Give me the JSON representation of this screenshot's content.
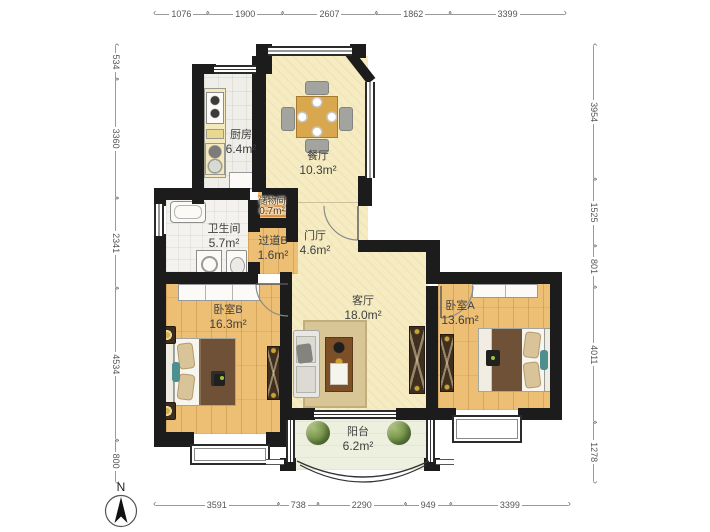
{
  "plan": {
    "compass_label": "N",
    "rooms": [
      {
        "id": "kitchen",
        "name": "厨房",
        "area": "6.4m²"
      },
      {
        "id": "dining",
        "name": "餐厅",
        "area": "10.3m²"
      },
      {
        "id": "storage",
        "name": "储物间",
        "area": "0.7m²"
      },
      {
        "id": "bathroom",
        "name": "卫生间",
        "area": "5.7m²"
      },
      {
        "id": "hallway",
        "name": "过道B",
        "area": "1.6m²"
      },
      {
        "id": "foyer",
        "name": "门厅",
        "area": "4.6m²"
      },
      {
        "id": "living",
        "name": "客厅",
        "area": "18.0m²"
      },
      {
        "id": "bedroom_b",
        "name": "卧室B",
        "area": "16.3m²"
      },
      {
        "id": "bedroom_a",
        "name": "卧室A",
        "area": "13.6m²"
      },
      {
        "id": "balcony",
        "name": "阳台",
        "area": "6.2m²"
      }
    ],
    "dimensions": {
      "top": [
        "1076",
        "1900",
        "2607",
        "1862",
        "3399"
      ],
      "bottom": [
        "3591",
        "738",
        "2290",
        "949",
        "3399"
      ],
      "left": [
        "534",
        "3360",
        "2341",
        "4534",
        "800"
      ],
      "right": [
        "3954",
        "1525",
        "801",
        "4011",
        "1278"
      ]
    },
    "colors": {
      "wall": "#1c1c1c",
      "floor_public": "#f6ecc3",
      "floor_wood": "#ecbf74",
      "floor_tile": "#efeee8",
      "storage_shelf": "#d98f3e",
      "dim_text": "#555555"
    }
  }
}
